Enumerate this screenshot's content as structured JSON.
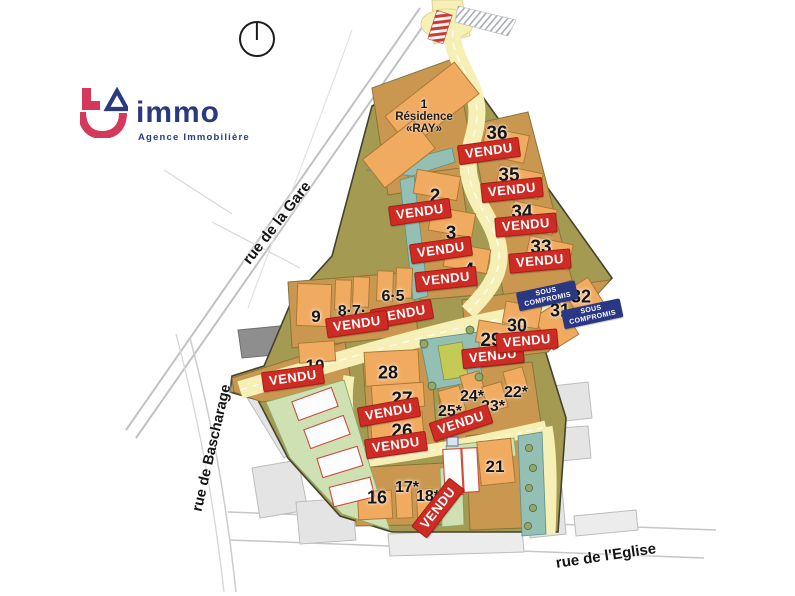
{
  "branding": {
    "name": "immo",
    "tagline": "Agence Immobilière",
    "colors": {
      "navy": "#2b3a80",
      "pink": "#d4395c"
    }
  },
  "compass": {
    "icon": "north-circle"
  },
  "streets": [
    {
      "id": "gare",
      "name": "rue de la Gare"
    },
    {
      "id": "bascharage",
      "name": "rue de Bascharage"
    },
    {
      "id": "eglise",
      "name": "rue de l'Eglise"
    }
  ],
  "residence": {
    "number": "1",
    "line1": "Résidence",
    "line2": "«RAY»"
  },
  "status_labels": {
    "sold": "VENDU",
    "under_offer_line1": "SOUS",
    "under_offer_line2": "COMPROMIS"
  },
  "colors": {
    "sold_bg": "#ce2b24",
    "under_offer_bg": "#2a3782",
    "lot_fill": "#f0ab61",
    "terrain": "#a59a52",
    "road": "#f6efb6",
    "teal": "#93bfb4",
    "green": "#cfe0b2"
  },
  "lots": [
    {
      "id": "1",
      "label": "1",
      "status": null
    },
    {
      "id": "2",
      "label": "2",
      "status": "sold"
    },
    {
      "id": "3",
      "label": "3",
      "status": "sold"
    },
    {
      "id": "4",
      "label": "4",
      "status": "sold"
    },
    {
      "id": "5-6",
      "label": "6·5",
      "status": "sold"
    },
    {
      "id": "7-8",
      "label": "8·7·",
      "status": "sold"
    },
    {
      "id": "9",
      "label": "9",
      "status": null
    },
    {
      "id": "10",
      "label": "10",
      "status": "sold"
    },
    {
      "id": "16",
      "label": "16",
      "status": null
    },
    {
      "id": "17",
      "label": "17*",
      "status": null
    },
    {
      "id": "18",
      "label": "18*",
      "status": "sold"
    },
    {
      "id": "21",
      "label": "21",
      "status": null
    },
    {
      "id": "22",
      "label": "22*",
      "status": null
    },
    {
      "id": "23",
      "label": "23*",
      "status": null
    },
    {
      "id": "24",
      "label": "24*",
      "status": null
    },
    {
      "id": "25",
      "label": "25*",
      "status": "sold"
    },
    {
      "id": "26",
      "label": "26",
      "status": "sold"
    },
    {
      "id": "27",
      "label": "27",
      "status": "sold"
    },
    {
      "id": "28",
      "label": "28",
      "status": null
    },
    {
      "id": "29",
      "label": "29",
      "status": "sold"
    },
    {
      "id": "30",
      "label": "30",
      "status": "sold"
    },
    {
      "id": "31",
      "label": "31",
      "status": "under_offer"
    },
    {
      "id": "32",
      "label": "32",
      "status": "under_offer"
    },
    {
      "id": "33",
      "label": "33",
      "status": "sold"
    },
    {
      "id": "34",
      "label": "34",
      "status": "sold"
    },
    {
      "id": "35",
      "label": "35",
      "status": "sold"
    },
    {
      "id": "36",
      "label": "36",
      "status": "sold"
    }
  ]
}
